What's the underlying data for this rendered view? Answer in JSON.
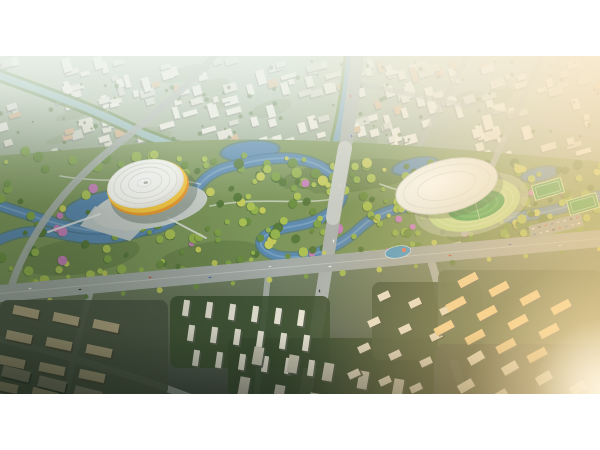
{
  "meta": {
    "description": "Aerial golden-hour rendering of an urban masterplan: a long central river park with a yellow-banded domed arena on the left and a white-roofed stadium with running track on the right, surrounded by dense residential districts fading into haze."
  },
  "frame": {
    "background": "#ffffff",
    "photo_top": 56,
    "photo_height": 338,
    "photo_width": 600
  },
  "palette": {
    "ground_top": "#c2cdbd",
    "ground_mid": "#8fa184",
    "ground_low": "#69775c",
    "ground_bottom": "#49524a",
    "water": "#5b89af",
    "water_deep": "#3f6d96",
    "water_light": "#8db3cf",
    "river_haze": "#9cc0c4",
    "bank_green": "#6b8a52",
    "canal_water": "#7fa7c4",
    "canal_bank": "#6f9150",
    "road": "#aab1ad",
    "road_light": "#c6ccc8",
    "boulevard": "#a3aaa6",
    "road_centerline": "#c9cfcb",
    "bld_white": "#eceadf",
    "bld_cream": "#e3e1d4",
    "bld_gray": "#d3d6ca",
    "bld_shadow": "#8e958a",
    "bld_roof_orange": "#d8b48e",
    "city_green": "#7e9465",
    "city_dot": "#5d7a44",
    "park_base": "#7c955a",
    "park_dark": "#5d7742",
    "greens": [
      "#57793b",
      "#6b8f41",
      "#7fa348",
      "#93b24e",
      "#a9c054"
    ],
    "tree_yellow": "#c3ca5b",
    "tree_pink": "#c47fb9",
    "tree_shadow": "#42602f",
    "path_white": "#e9ece9",
    "stad_yellow": "#f5c843",
    "stad_orange": "#e89a30",
    "stad_white": "#f7f7f2",
    "stad_ring": "#d9dad0",
    "roof_white": "#f0f3ef",
    "roof_line": "#d8dcd4",
    "track": "#bedb8e",
    "track_line": "#d7e8b4",
    "pitch": "#3f9e4c",
    "pitch_light": "#55b25a",
    "field_green": "#3f9e4c",
    "field_line": "#d2e4b2",
    "parking": "#9aa39f",
    "plaza": "#ccd2cf",
    "playground_blue": "#4a9bc9",
    "playground_red": "#e8735a",
    "sun_glow": "#ffd98f",
    "sun_core": "#ffe9bc",
    "sun_center": "#fff6e2",
    "warm_tint": "rgba(255,205,130,0.32)",
    "haze": "#eef5ee",
    "vignette": "rgba(22,34,22,0.5)"
  },
  "scene": {
    "rivers": {
      "topLeft": {
        "path": "M -5,18 C 50,38 90,52 130,72 C 160,86 180,92 205,97",
        "w": 7
      },
      "canal": {
        "path": "M 350,-5 C 346,40 340,70 331,105 C 326,124 321,138 316,152",
        "w": 6
      },
      "parkMain": {
        "path": "M -5,148 C 55,168 95,182 148,174 C 196,167 183,123 228,111 C 270,100 305,96 332,118 C 356,137 337,163 295,170 C 262,175 250,188 272,198 C 290,206 330,200 360,172 C 385,149 420,146 452,156 C 490,168 540,162 598,140",
        "w": 9
      },
      "parkBranch": {
        "path": "M 150,172 C 120,185 90,186 60,178 C 35,172 15,176 -5,186",
        "w": 8
      },
      "lakes": [
        [
          120,
          150,
          55,
          16,
          -8
        ],
        [
          250,
          95,
          28,
          9,
          -5
        ],
        [
          415,
          110,
          22,
          7,
          -12
        ],
        [
          540,
          118,
          18,
          6,
          -12
        ]
      ]
    },
    "park": {
      "outline": "M -5,100 L 160,86 C 300,78 420,90 605,106 L 605,186 C 420,204 150,226 -5,240 Z",
      "island": [
        292,
        148,
        26,
        16,
        -10
      ],
      "patches": [
        [
          80,
          200,
          60,
          18,
          -8
        ],
        [
          350,
          120,
          70,
          16,
          -6
        ],
        [
          500,
          170,
          55,
          14,
          -10
        ],
        [
          210,
          200,
          50,
          14,
          -8
        ]
      ],
      "treeCount": 320,
      "walkPaths": [
        "M 60,120 C 120,130 160,118 200,128",
        "M 210,150 C 260,140 300,150 340,142",
        "M 380,128 C 430,148 480,138 530,150",
        "M 340,200 C 390,190 430,196 460,186"
      ]
    },
    "roads": {
      "mainVertical": {
        "d": "M 358,-5 C 350,60 342,120 334,160 C 329,192 322,240 314,290 C 310,315 307,330 304,343",
        "w": 13
      },
      "bridge": {
        "d": "M 345,92 C 340,118 336,140 333,162",
        "w": 14
      },
      "boulevard": {
        "d": "M -5,238 C 150,224 340,206 605,182",
        "w": 17
      },
      "minor": [
        {
          "d": "M 218,-5 C 185,35 150,62 115,90 C 85,114 60,140 42,168 C 28,190 18,210 12,228",
          "w": 7,
          "o": 0.9
        },
        {
          "d": "M 470,-5 C 452,30 435,60 420,88",
          "w": 5,
          "o": 0.7
        },
        {
          "d": "M 545,-5 C 525,40 505,80 492,110 C 480,138 470,160 464,178",
          "w": 6,
          "o": 0.8
        },
        {
          "d": "M 358,28 C 430,42 520,60 605,82",
          "w": 5,
          "o": 0.65
        },
        {
          "d": "M 432,208 C 446,250 444,295 468,343",
          "w": 8,
          "o": 0.95
        },
        {
          "d": "M -5,282 C 70,300 140,322 195,343",
          "w": 7,
          "o": 0.9
        },
        {
          "d": "M 92,232 C 80,270 72,305 66,343",
          "w": 6,
          "o": 0.85
        },
        {
          "d": "M 268,218 C 264,260 260,300 256,343",
          "w": 6,
          "o": 0.85
        }
      ],
      "boulevardTreeDots": 34
    },
    "city": {
      "count": 230,
      "dotCount": 90,
      "patchCount": 14,
      "rot": -16
    },
    "stadiumLeft": {
      "cx": 147,
      "cy": 130,
      "rot": -12,
      "plaza": [
        150,
        151,
        58,
        21,
        -10
      ],
      "bridges": [
        "M 100,158 L 48,176",
        "M 168,162 L 206,182"
      ]
    },
    "stadiumRight": {
      "cx": 474,
      "cy": 149,
      "rot": -14
    },
    "fields": [
      [
        548,
        133,
        30,
        15,
        -16
      ],
      [
        583,
        148,
        30,
        15,
        -16
      ]
    ],
    "parking": {
      "cx": 556,
      "cy": 170,
      "w": 54,
      "h": 13,
      "rot": -14,
      "cars": 16
    },
    "playground": [
      398,
      196,
      13,
      6,
      -10
    ],
    "bases": [
      [
        0,
        244,
        168,
        96,
        "#4d5645"
      ],
      [
        170,
        240,
        160,
        72,
        "#3e5233"
      ],
      [
        228,
        282,
        206,
        58,
        "#3a4c31"
      ],
      [
        372,
        226,
        110,
        78,
        "#46583b"
      ],
      [
        438,
        214,
        164,
        82,
        "#5a6b4e"
      ],
      [
        436,
        288,
        166,
        52,
        "#4e5a46"
      ]
    ],
    "clusters": [
      {
        "o": [
          26,
          256
        ],
        "rows": 4,
        "cols": 3,
        "cv": [
          40,
          7
        ],
        "rv": [
          -7,
          25
        ],
        "bw": 26,
        "bh": 9,
        "rot": 12,
        "f": "#b5a784",
        "s": "#4c4a38"
      },
      {
        "o": [
          16,
          318
        ],
        "rows": 2,
        "cols": 4,
        "cv": [
          36,
          10
        ],
        "rv": [
          -9,
          26
        ],
        "bw": 28,
        "bh": 11,
        "rot": 14,
        "f": "#8f8a76",
        "s": "#2f362c"
      },
      {
        "o": [
          186,
          252
        ],
        "rows": 3,
        "cols": 6,
        "cv": [
          23,
          2
        ],
        "rv": [
          5,
          25
        ],
        "bw": 6,
        "bh": 16,
        "rot": 8,
        "f": "#e6e3d4",
        "s": "#5a6152"
      },
      {
        "o": [
          258,
          300
        ],
        "rows": 3,
        "cols": 5,
        "cv": [
          35,
          8
        ],
        "rv": [
          -14,
          30
        ],
        "bw": 10,
        "bh": 18,
        "rot": 10,
        "f": "#cdc9b8",
        "s": "#4e554a"
      },
      {
        "o": [
          384,
          240
        ],
        "rows": 4,
        "cols": 3,
        "cv": [
          31,
          7
        ],
        "rv": [
          -10,
          26
        ],
        "bw": 12,
        "bh": 7,
        "rot": -25,
        "f": "#e4ddc9",
        "s": "#4a523f"
      },
      {
        "o": [
          468,
          224
        ],
        "rows": 3,
        "cols": 4,
        "cv": [
          31,
          9
        ],
        "rv": [
          -12,
          24
        ],
        "bw": 20,
        "bh": 8,
        "rot": -28,
        "f": "#f2cf92",
        "s": "#5f665a"
      },
      {
        "o": [
          476,
          302
        ],
        "rows": 3,
        "cols": 4,
        "cv": [
          34,
          10
        ],
        "rv": [
          -10,
          28
        ],
        "bw": 16,
        "bh": 9,
        "rot": -30,
        "f": "#efe7d2",
        "s": "#56604f"
      }
    ],
    "cars": {
      "boulevard": [
        [
          30,
          235
        ],
        [
          80,
          231
        ],
        [
          150,
          224
        ],
        [
          210,
          219
        ],
        [
          270,
          213
        ],
        [
          330,
          208
        ],
        [
          390,
          202
        ],
        [
          450,
          197
        ],
        [
          510,
          191
        ],
        [
          560,
          187
        ]
      ],
      "rotB": -6,
      "vertical": [
        [
          353,
          40
        ],
        [
          349,
          80
        ],
        [
          342,
          130
        ],
        [
          331,
          185
        ],
        [
          322,
          235
        ],
        [
          316,
          275
        ],
        [
          310,
          310
        ]
      ],
      "rotV": 84,
      "colors": [
        "#f0efe8",
        "#3a3f3a",
        "#c94f43",
        "#4a6fa5",
        "#d8d8d8"
      ]
    }
  }
}
